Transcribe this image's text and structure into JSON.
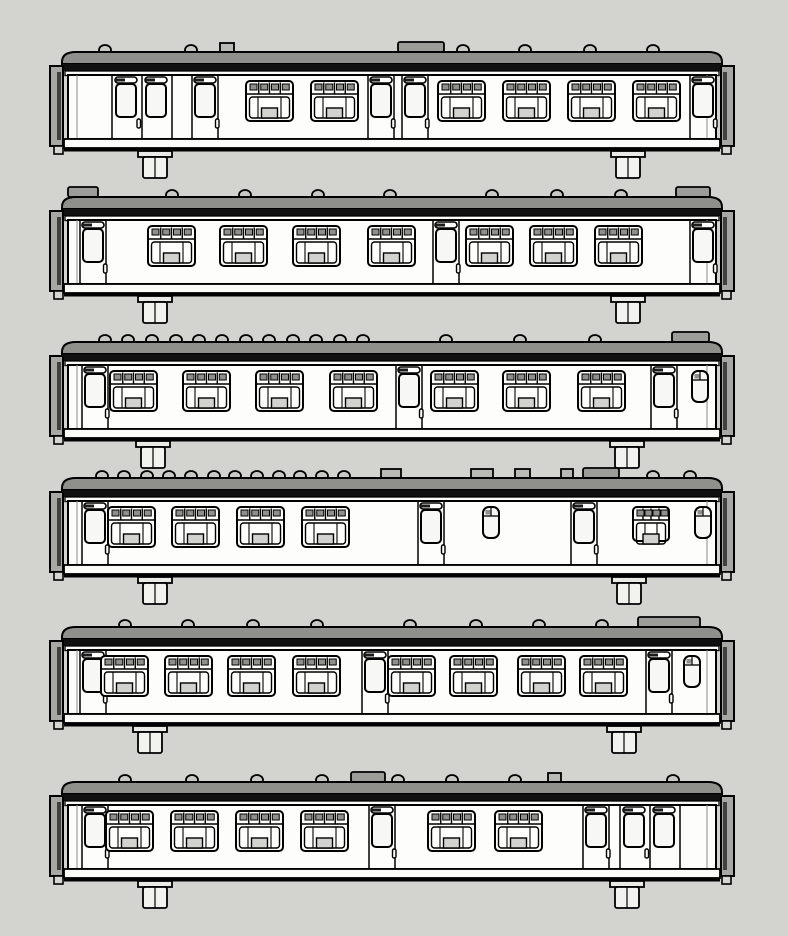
{
  "app": {
    "background_color": "#d3d3cf",
    "drawing_style": "technical-line-art",
    "content": "six-railway-coach-side-elevations"
  },
  "palette": {
    "outline": "#000000",
    "body_white": "#fdfdfb",
    "roof_gray": "#8f8f8b",
    "roof_stripe": "#101010",
    "slab_gray": "#a7a7a3",
    "slab_dark": "#40403e",
    "vent_gray": "#c9c9c5",
    "box_gray": "#b9b9b5",
    "glass": "#f7f7f5",
    "block_gray": "#d2d2ce",
    "under_gray": "#f2f2ee"
  },
  "coaches": [
    {
      "id": "coach-1",
      "y": 52,
      "els": [
        {
          "t": "dd",
          "x": 44
        },
        {
          "t": "door",
          "x": 124
        },
        {
          "t": "win",
          "x": 178
        },
        {
          "t": "win",
          "x": 243
        },
        {
          "t": "door",
          "x": 300
        },
        {
          "t": "door",
          "x": 334
        },
        {
          "t": "win",
          "x": 370
        },
        {
          "t": "win",
          "x": 435
        },
        {
          "t": "win",
          "x": 500
        },
        {
          "t": "win",
          "x": 565
        },
        {
          "t": "door",
          "x": 622
        }
      ],
      "vents": [
        {
          "t": "r",
          "x": 37
        },
        {
          "t": "r",
          "x": 123
        },
        {
          "t": "b",
          "x": 152,
          "w": 14
        },
        {
          "t": "lb",
          "x": 330,
          "w": 46
        },
        {
          "t": "r",
          "x": 395
        },
        {
          "t": "r",
          "x": 457
        },
        {
          "t": "r",
          "x": 522
        },
        {
          "t": "r",
          "x": 585
        }
      ],
      "under": [
        87,
        560
      ]
    },
    {
      "id": "coach-2",
      "y": 197,
      "els": [
        {
          "t": "door",
          "x": 12
        },
        {
          "t": "win",
          "x": 80
        },
        {
          "t": "win",
          "x": 152
        },
        {
          "t": "win",
          "x": 225
        },
        {
          "t": "win",
          "x": 300
        },
        {
          "t": "door",
          "x": 365
        },
        {
          "t": "win",
          "x": 398
        },
        {
          "t": "win",
          "x": 462
        },
        {
          "t": "win",
          "x": 527
        },
        {
          "t": "door",
          "x": 622
        }
      ],
      "vents": [
        {
          "t": "lb",
          "x": 0,
          "w": 30
        },
        {
          "t": "r",
          "x": 104
        },
        {
          "t": "r",
          "x": 177
        },
        {
          "t": "r",
          "x": 250
        },
        {
          "t": "r",
          "x": 322
        },
        {
          "t": "r",
          "x": 424
        },
        {
          "t": "r",
          "x": 489
        },
        {
          "t": "r",
          "x": 553
        },
        {
          "t": "lb",
          "x": 608,
          "w": 34
        }
      ],
      "under": [
        87,
        560
      ]
    },
    {
      "id": "coach-3",
      "y": 342,
      "els": [
        {
          "t": "door",
          "x": 14
        },
        {
          "t": "win",
          "x": 42
        },
        {
          "t": "win",
          "x": 115
        },
        {
          "t": "win",
          "x": 188
        },
        {
          "t": "win",
          "x": 262
        },
        {
          "t": "door",
          "x": 328
        },
        {
          "t": "win",
          "x": 363
        },
        {
          "t": "win",
          "x": 435
        },
        {
          "t": "win",
          "x": 510
        },
        {
          "t": "door",
          "x": 583
        },
        {
          "t": "toilet",
          "x": 624
        }
      ],
      "vents": [
        {
          "t": "r",
          "x": 37
        },
        {
          "t": "r",
          "x": 60
        },
        {
          "t": "r",
          "x": 84
        },
        {
          "t": "r",
          "x": 108
        },
        {
          "t": "r",
          "x": 131
        },
        {
          "t": "r",
          "x": 154
        },
        {
          "t": "r",
          "x": 178
        },
        {
          "t": "r",
          "x": 201
        },
        {
          "t": "r",
          "x": 225
        },
        {
          "t": "r",
          "x": 248
        },
        {
          "t": "r",
          "x": 272
        },
        {
          "t": "r",
          "x": 295
        },
        {
          "t": "r",
          "x": 378
        },
        {
          "t": "r",
          "x": 452
        },
        {
          "t": "r",
          "x": 527
        },
        {
          "t": "lb",
          "x": 604,
          "w": 37
        }
      ],
      "under": [
        85,
        559
      ]
    },
    {
      "id": "coach-4",
      "y": 478,
      "els": [
        {
          "t": "door",
          "x": 14
        },
        {
          "t": "win",
          "x": 40
        },
        {
          "t": "win",
          "x": 104
        },
        {
          "t": "win",
          "x": 169
        },
        {
          "t": "win",
          "x": 234
        },
        {
          "t": "door",
          "x": 350
        },
        {
          "t": "toilet",
          "x": 415
        },
        {
          "t": "door",
          "x": 503
        },
        {
          "t": "guard",
          "x": 565
        },
        {
          "t": "toilet",
          "x": 627
        }
      ],
      "vents": [
        {
          "t": "r",
          "x": 34
        },
        {
          "t": "r",
          "x": 56
        },
        {
          "t": "r",
          "x": 79
        },
        {
          "t": "r",
          "x": 101
        },
        {
          "t": "r",
          "x": 123
        },
        {
          "t": "r",
          "x": 146
        },
        {
          "t": "r",
          "x": 167
        },
        {
          "t": "r",
          "x": 189
        },
        {
          "t": "r",
          "x": 211
        },
        {
          "t": "r",
          "x": 232
        },
        {
          "t": "r",
          "x": 254
        },
        {
          "t": "r",
          "x": 276
        },
        {
          "t": "b",
          "x": 313,
          "w": 20
        },
        {
          "t": "b",
          "x": 403,
          "w": 22
        },
        {
          "t": "b",
          "x": 447,
          "w": 15
        },
        {
          "t": "b",
          "x": 493,
          "w": 12
        },
        {
          "t": "lb",
          "x": 515,
          "w": 36
        },
        {
          "t": "r",
          "x": 585
        },
        {
          "t": "r",
          "x": 622
        }
      ],
      "under": [
        87,
        561
      ]
    },
    {
      "id": "coach-5",
      "y": 627,
      "els": [
        {
          "t": "door",
          "x": 12
        },
        {
          "t": "win",
          "x": 33
        },
        {
          "t": "win",
          "x": 97
        },
        {
          "t": "win",
          "x": 160
        },
        {
          "t": "win",
          "x": 225
        },
        {
          "t": "door",
          "x": 294
        },
        {
          "t": "win",
          "x": 320
        },
        {
          "t": "win",
          "x": 382
        },
        {
          "t": "win",
          "x": 450
        },
        {
          "t": "win",
          "x": 512
        },
        {
          "t": "door",
          "x": 578
        },
        {
          "t": "toilet",
          "x": 616
        }
      ],
      "vents": [
        {
          "t": "r",
          "x": 57
        },
        {
          "t": "r",
          "x": 120
        },
        {
          "t": "r",
          "x": 185
        },
        {
          "t": "r",
          "x": 249
        },
        {
          "t": "r",
          "x": 342
        },
        {
          "t": "r",
          "x": 408
        },
        {
          "t": "r",
          "x": 471
        },
        {
          "t": "r",
          "x": 534
        },
        {
          "t": "lb",
          "x": 570,
          "w": 62
        }
      ],
      "under": [
        82,
        556
      ]
    },
    {
      "id": "coach-6",
      "y": 782,
      "els": [
        {
          "t": "door",
          "x": 14
        },
        {
          "t": "win",
          "x": 38
        },
        {
          "t": "win",
          "x": 103
        },
        {
          "t": "win",
          "x": 168
        },
        {
          "t": "win",
          "x": 233
        },
        {
          "t": "door",
          "x": 301
        },
        {
          "t": "win",
          "x": 360
        },
        {
          "t": "win",
          "x": 427
        },
        {
          "t": "door",
          "x": 515
        },
        {
          "t": "dd",
          "x": 552
        }
      ],
      "vents": [
        {
          "t": "r",
          "x": 57
        },
        {
          "t": "r",
          "x": 124
        },
        {
          "t": "r",
          "x": 189
        },
        {
          "t": "r",
          "x": 254
        },
        {
          "t": "lb",
          "x": 283,
          "w": 34
        },
        {
          "t": "r",
          "x": 330
        },
        {
          "t": "r",
          "x": 384
        },
        {
          "t": "r",
          "x": 447
        },
        {
          "t": "b",
          "x": 480,
          "w": 13
        },
        {
          "t": "r",
          "x": 605
        }
      ],
      "under": [
        87,
        559
      ]
    }
  ]
}
